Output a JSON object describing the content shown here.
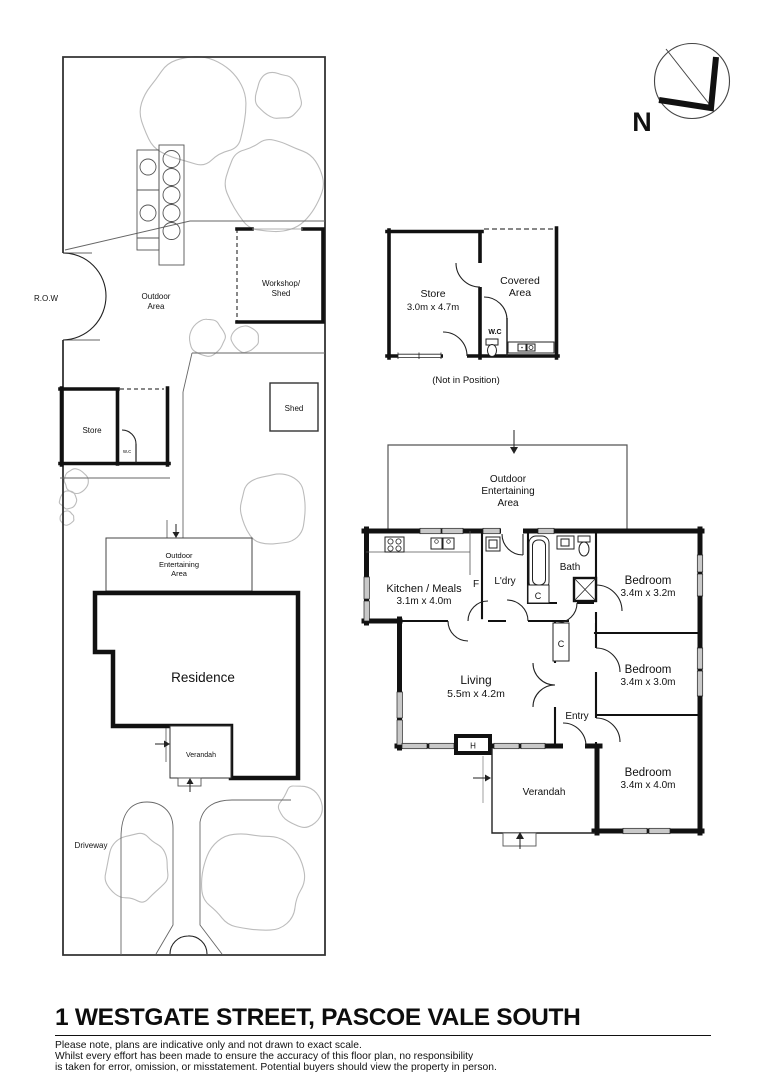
{
  "title_block": {
    "title": "1 WESTGATE STREET, PASCOE VALE SOUTH",
    "disclaimer": [
      "Please note, plans are indicative only and not drawn to exact scale.",
      "Whilst every effort has been made to ensure the accuracy of this floor plan, no responsibility",
      "is taken for error, omission, or misstatement. Potential buyers should view the property in person."
    ]
  },
  "compass": {
    "north": "N"
  },
  "site_plan": {
    "row_label": "R.O.W",
    "outdoor_area": [
      "Outdoor",
      "Area"
    ],
    "workshop_shed": [
      "Workshop/",
      "Shed"
    ],
    "store": "Store",
    "wc": "w.c",
    "shed": "Shed",
    "outdoor_entertaining": [
      "Outdoor",
      "Entertaining",
      "Area"
    ],
    "residence": "Residence",
    "verandah": "Verandah",
    "driveway": "Driveway"
  },
  "store_plan": {
    "store_name": "Store",
    "store_dims": "3.0m x 4.7m",
    "covered_area": [
      "Covered",
      "Area"
    ],
    "wc": "W.C",
    "note": "(Not in Position)"
  },
  "floor_plan": {
    "outdoor_entertaining": [
      "Outdoor",
      "Entertaining",
      "Area"
    ],
    "kitchen": {
      "name": "Kitchen / Meals",
      "dims": "3.1m x 4.0m"
    },
    "laundry": "L'dry",
    "bath": "Bath",
    "living": {
      "name": "Living",
      "dims": "5.5m x 4.2m"
    },
    "entry": "Entry",
    "verandah": "Verandah",
    "bedrooms": [
      {
        "name": "Bedroom",
        "dims": "3.4m x 3.2m"
      },
      {
        "name": "Bedroom",
        "dims": "3.4m x 3.0m"
      },
      {
        "name": "Bedroom",
        "dims": "3.4m x 4.0m"
      }
    ],
    "markers": {
      "fridge": "F",
      "cupboard": "C",
      "heater": "H"
    }
  }
}
